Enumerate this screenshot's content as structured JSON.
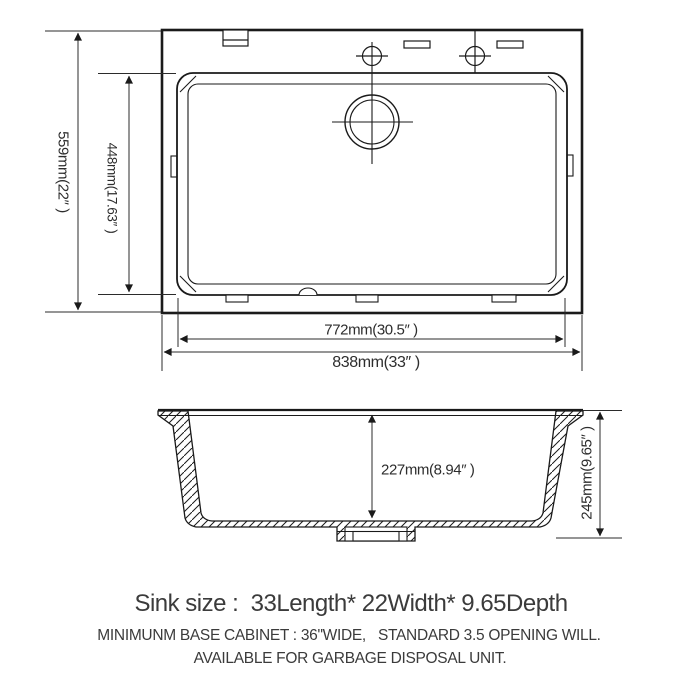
{
  "colors": {
    "background": "#ffffff",
    "line": "#1a1a1a",
    "dim_line": "#2b2b2b",
    "dim_text": "#2d2d2d",
    "footer_text": "#3b3b3b"
  },
  "top_view": {
    "description": "sink top view with rear faucet deck, two faucet holes, two slots, rear drain opening, mounting clips and tabs",
    "dimensions": {
      "overall_depth": "559mm(22″ )",
      "bowl_depth": "448mm(17.63″ )",
      "bowl_width": "772mm(30.5″ )",
      "overall_width": "838mm(33″ )"
    }
  },
  "side_view": {
    "description": "sink cross-section with hatched walls, flanges and bottom drain fitting",
    "dimensions": {
      "bowl_inner_depth": "227mm(8.94″ )",
      "overall_height": "245mm(9.65″ )"
    }
  },
  "footer": {
    "sink_size": "Sink size :  33Length* 22Width* 9.65Depth",
    "cabinet_note": "MINIMUNM BASE CABINET : 36\"WIDE,   STANDARD 3.5 OPENING WILL.",
    "disposal_note": "AVAILABLE FOR GARBAGE DISPOSAL UNIT."
  }
}
